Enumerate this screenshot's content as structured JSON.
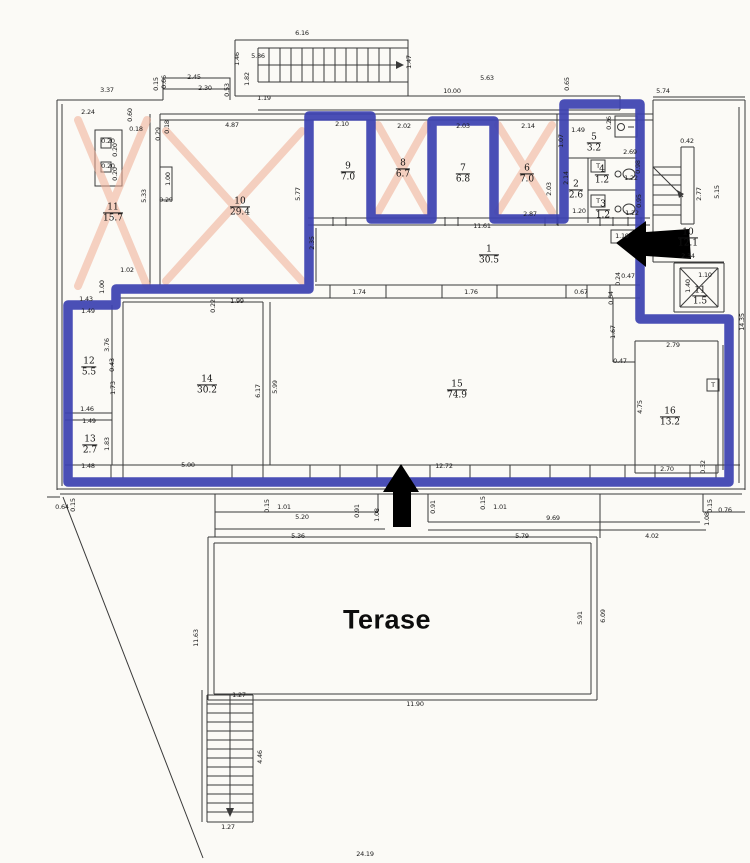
{
  "colors": {
    "outline": "#3c42b0",
    "cross": "#f0ad93",
    "wall": "#3a3a3a",
    "arrow": "#000000"
  },
  "plan": {
    "terrace_label": "Terase",
    "rooms": [
      {
        "number": "11",
        "area": "15.7",
        "x": 113,
        "y": 213
      },
      {
        "number": "10",
        "area": "29.4",
        "x": 240,
        "y": 207
      },
      {
        "number": "9",
        "area": "7.0",
        "x": 348,
        "y": 172
      },
      {
        "number": "8",
        "area": "6.7",
        "x": 403,
        "y": 169
      },
      {
        "number": "7",
        "area": "6.8",
        "x": 463,
        "y": 174
      },
      {
        "number": "6",
        "area": "7.0",
        "x": 527,
        "y": 174
      },
      {
        "number": "5",
        "area": "3.2",
        "x": 594,
        "y": 143
      },
      {
        "number": "4",
        "area": "1.2",
        "x": 602,
        "y": 175
      },
      {
        "number": "3",
        "area": "1.2",
        "x": 603,
        "y": 210
      },
      {
        "number": "2",
        "area": "2.6",
        "x": 576,
        "y": 190
      },
      {
        "number": "1",
        "area": "30.5",
        "x": 489,
        "y": 255
      },
      {
        "number": "10",
        "area": "12.1",
        "x": 688,
        "y": 238
      },
      {
        "number": "11",
        "area": "1.5",
        "x": 700,
        "y": 296
      },
      {
        "number": "12",
        "area": "5.5",
        "x": 89,
        "y": 367
      },
      {
        "number": "13",
        "area": "2.7",
        "x": 90,
        "y": 445
      },
      {
        "number": "14",
        "area": "30.2",
        "x": 207,
        "y": 385
      },
      {
        "number": "15",
        "area": "74.9",
        "x": 457,
        "y": 390
      },
      {
        "number": "16",
        "area": "13.2",
        "x": 670,
        "y": 417
      }
    ],
    "dims": [
      {
        "t": "6.16",
        "x": 302,
        "y": 33
      },
      {
        "t": "5.86",
        "x": 258,
        "y": 56
      },
      {
        "t": "1.46",
        "x": 237,
        "y": 59,
        "v": 1
      },
      {
        "t": "1.82",
        "x": 247,
        "y": 79,
        "v": 1
      },
      {
        "t": "1.47",
        "x": 409,
        "y": 62,
        "v": 1
      },
      {
        "t": "2.45",
        "x": 194,
        "y": 77
      },
      {
        "t": "2.30",
        "x": 205,
        "y": 88
      },
      {
        "t": "0.53",
        "x": 227,
        "y": 90,
        "v": 1
      },
      {
        "t": "1.19",
        "x": 264,
        "y": 98
      },
      {
        "t": "0.15",
        "x": 156,
        "y": 84,
        "v": 1
      },
      {
        "t": "0.66",
        "x": 164,
        "y": 82,
        "v": 1
      },
      {
        "t": "3.37",
        "x": 107,
        "y": 90
      },
      {
        "t": "5.63",
        "x": 487,
        "y": 78
      },
      {
        "t": "10.00",
        "x": 452,
        "y": 91
      },
      {
        "t": "0.65",
        "x": 567,
        "y": 84,
        "v": 1
      },
      {
        "t": "5.74",
        "x": 663,
        "y": 91
      },
      {
        "t": "2.24",
        "x": 88,
        "y": 112
      },
      {
        "t": "0.60",
        "x": 130,
        "y": 115,
        "v": 1
      },
      {
        "t": "0.18",
        "x": 136,
        "y": 129
      },
      {
        "t": "0.29",
        "x": 158,
        "y": 134,
        "v": 1
      },
      {
        "t": "0.18",
        "x": 167,
        "y": 127,
        "v": 1
      },
      {
        "t": "4.87",
        "x": 232,
        "y": 125
      },
      {
        "t": "1.00",
        "x": 168,
        "y": 179,
        "v": 1
      },
      {
        "t": "0.29",
        "x": 166,
        "y": 200
      },
      {
        "t": "5.33",
        "x": 144,
        "y": 196,
        "v": 1
      },
      {
        "t": "1.02",
        "x": 127,
        "y": 270
      },
      {
        "t": "0.20",
        "x": 108,
        "y": 141
      },
      {
        "t": "0.20",
        "x": 115,
        "y": 150,
        "v": 1
      },
      {
        "t": "0.20",
        "x": 108,
        "y": 166
      },
      {
        "t": "0.20",
        "x": 115,
        "y": 174,
        "v": 1
      },
      {
        "t": "1.00",
        "x": 102,
        "y": 287,
        "v": 1
      },
      {
        "t": "1.43",
        "x": 86,
        "y": 299
      },
      {
        "t": "1.49",
        "x": 88,
        "y": 311
      },
      {
        "t": "2.10",
        "x": 342,
        "y": 124
      },
      {
        "t": "2.02",
        "x": 404,
        "y": 126
      },
      {
        "t": "2.03",
        "x": 463,
        "y": 126
      },
      {
        "t": "2.14",
        "x": 528,
        "y": 126
      },
      {
        "t": "5.77",
        "x": 298,
        "y": 194,
        "v": 1
      },
      {
        "t": "2.35",
        "x": 312,
        "y": 243,
        "v": 1
      },
      {
        "t": "2.87",
        "x": 530,
        "y": 214
      },
      {
        "t": "2.03",
        "x": 549,
        "y": 189,
        "v": 1
      },
      {
        "t": "2.14",
        "x": 566,
        "y": 178,
        "v": 1
      },
      {
        "t": "1.49",
        "x": 578,
        "y": 130
      },
      {
        "t": "1.07",
        "x": 561,
        "y": 141,
        "v": 1
      },
      {
        "t": "0.26",
        "x": 609,
        "y": 123,
        "v": 1
      },
      {
        "t": "2.69",
        "x": 630,
        "y": 152
      },
      {
        "t": "0.98",
        "x": 638,
        "y": 167,
        "v": 1
      },
      {
        "t": "1.22",
        "x": 631,
        "y": 178
      },
      {
        "t": "0.95",
        "x": 639,
        "y": 201,
        "v": 1
      },
      {
        "t": "1.22",
        "x": 632,
        "y": 213
      },
      {
        "t": "1.20",
        "x": 579,
        "y": 211
      },
      {
        "t": "11.61",
        "x": 482,
        "y": 226
      },
      {
        "t": "1.19",
        "x": 622,
        "y": 236
      },
      {
        "t": "0.42",
        "x": 687,
        "y": 141
      },
      {
        "t": "2.77",
        "x": 699,
        "y": 194,
        "v": 1
      },
      {
        "t": "5.15",
        "x": 717,
        "y": 192,
        "v": 1
      },
      {
        "t": "2.34",
        "x": 688,
        "y": 256
      },
      {
        "t": "1.10",
        "x": 705,
        "y": 275
      },
      {
        "t": "1.40",
        "x": 688,
        "y": 286,
        "v": 1
      },
      {
        "t": "14.35",
        "x": 742,
        "y": 322,
        "v": 1
      },
      {
        "t": "0.47",
        "x": 628,
        "y": 276
      },
      {
        "t": "0.24",
        "x": 618,
        "y": 279,
        "v": 1
      },
      {
        "t": "0.64",
        "x": 611,
        "y": 298,
        "v": 1
      },
      {
        "t": "1.74",
        "x": 359,
        "y": 292
      },
      {
        "t": "1.76",
        "x": 471,
        "y": 292
      },
      {
        "t": "0.67",
        "x": 581,
        "y": 292
      },
      {
        "t": "0.22",
        "x": 213,
        "y": 306,
        "v": 1
      },
      {
        "t": "1.99",
        "x": 237,
        "y": 301
      },
      {
        "t": "3.76",
        "x": 107,
        "y": 345,
        "v": 1
      },
      {
        "t": "0.43",
        "x": 112,
        "y": 365,
        "v": 1
      },
      {
        "t": "1.73",
        "x": 113,
        "y": 388,
        "v": 1
      },
      {
        "t": "1.46",
        "x": 87,
        "y": 409
      },
      {
        "t": "1.49",
        "x": 89,
        "y": 421
      },
      {
        "t": "1.83",
        "x": 107,
        "y": 444,
        "v": 1
      },
      {
        "t": "1.48",
        "x": 88,
        "y": 466
      },
      {
        "t": "6.17",
        "x": 258,
        "y": 391,
        "v": 1
      },
      {
        "t": "5.99",
        "x": 275,
        "y": 387,
        "v": 1
      },
      {
        "t": "1.67",
        "x": 613,
        "y": 332,
        "v": 1
      },
      {
        "t": "0.47",
        "x": 620,
        "y": 361
      },
      {
        "t": "2.79",
        "x": 673,
        "y": 345
      },
      {
        "t": "4.75",
        "x": 640,
        "y": 407,
        "v": 1
      },
      {
        "t": "2.70",
        "x": 667,
        "y": 469
      },
      {
        "t": "0.32",
        "x": 703,
        "y": 467,
        "v": 1
      },
      {
        "t": "5.00",
        "x": 188,
        "y": 465
      },
      {
        "t": "12.72",
        "x": 444,
        "y": 466
      },
      {
        "t": "0.64",
        "x": 62,
        "y": 507
      },
      {
        "t": "0.15",
        "x": 73,
        "y": 505,
        "v": 1
      },
      {
        "t": "0.15",
        "x": 267,
        "y": 506,
        "v": 1
      },
      {
        "t": "1.01",
        "x": 284,
        "y": 507
      },
      {
        "t": "5.20",
        "x": 302,
        "y": 517
      },
      {
        "t": "0.91",
        "x": 357,
        "y": 511,
        "v": 1
      },
      {
        "t": "1.08",
        "x": 377,
        "y": 515,
        "v": 1
      },
      {
        "t": "5.36",
        "x": 298,
        "y": 536
      },
      {
        "t": "0.91",
        "x": 433,
        "y": 507,
        "v": 1
      },
      {
        "t": "0.15",
        "x": 483,
        "y": 503,
        "v": 1
      },
      {
        "t": "1.01",
        "x": 500,
        "y": 507
      },
      {
        "t": "9.69",
        "x": 553,
        "y": 518
      },
      {
        "t": "5.79",
        "x": 522,
        "y": 536
      },
      {
        "t": "4.02",
        "x": 652,
        "y": 536
      },
      {
        "t": "0.15",
        "x": 710,
        "y": 506,
        "v": 1
      },
      {
        "t": "1.08",
        "x": 707,
        "y": 519,
        "v": 1
      },
      {
        "t": "0.76",
        "x": 725,
        "y": 510
      },
      {
        "t": "11.63",
        "x": 196,
        "y": 638,
        "v": 1
      },
      {
        "t": "5.91",
        "x": 580,
        "y": 618,
        "v": 1
      },
      {
        "t": "6.09",
        "x": 603,
        "y": 616,
        "v": 1
      },
      {
        "t": "11.90",
        "x": 415,
        "y": 704
      },
      {
        "t": "1.27",
        "x": 239,
        "y": 695
      },
      {
        "t": "4.46",
        "x": 260,
        "y": 757,
        "v": 1
      },
      {
        "t": "1.27",
        "x": 228,
        "y": 827
      },
      {
        "t": "24.19",
        "x": 365,
        "y": 854
      },
      {
        "t": "T",
        "x": 598,
        "y": 166
      },
      {
        "t": "T",
        "x": 598,
        "y": 201
      },
      {
        "t": "T",
        "x": 713,
        "y": 385
      }
    ]
  }
}
